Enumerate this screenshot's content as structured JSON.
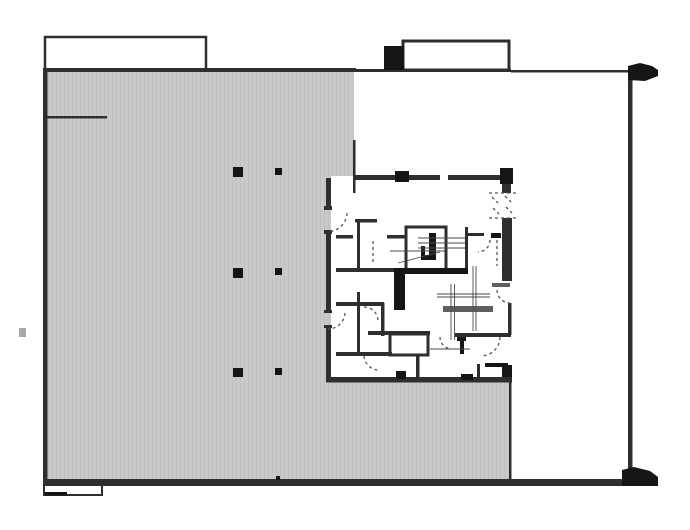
{
  "plan": {
    "viewbox": "0 0 690 530",
    "canvas": {
      "w": 690,
      "h": 530
    },
    "colors": {
      "background": "#ffffff",
      "wall": "#2e2e2e",
      "dark": "#151515",
      "mid": "#5f5f5f",
      "thin": "#4a4a4a",
      "dash": "#555555",
      "faint": "#a8a8a8",
      "deck_fill": "#c9c9c9",
      "deck_stripe": "#c1c1c1"
    },
    "deck_polygon": "47,72 354,72 354,176 331,176 331,380 510,380 510,480 47,480",
    "walls": [
      {
        "x": 43,
        "y": 68,
        "w": 313,
        "h": 4,
        "c": "wall",
        "name": "outer-top-wall-left"
      },
      {
        "x": 356,
        "y": 69,
        "w": 155,
        "h": 3,
        "c": "wall",
        "name": "outer-top-wall-mid"
      },
      {
        "x": 511,
        "y": 70,
        "w": 119,
        "h": 2.5,
        "c": "wall",
        "name": "outer-top-wall-right"
      },
      {
        "x": 43,
        "y": 70,
        "w": 4.5,
        "h": 413,
        "c": "wall",
        "name": "outer-left-wall"
      },
      {
        "x": 628,
        "y": 72,
        "w": 4.5,
        "h": 400,
        "c": "wall",
        "name": "outer-right-wall"
      },
      {
        "x": 43,
        "y": 479,
        "w": 593,
        "h": 7,
        "c": "wall",
        "name": "outer-bottom-wall"
      },
      {
        "x": 45,
        "y": 116,
        "w": 62,
        "h": 2.5,
        "c": "wall",
        "name": "interior-partition-topleft"
      },
      {
        "x": 353,
        "y": 140,
        "w": 2.5,
        "h": 53,
        "c": "wall",
        "name": "deck-edge-wall-north"
      },
      {
        "x": 509,
        "y": 380,
        "w": 2.5,
        "h": 100,
        "c": "wall",
        "name": "deck-edge-wall-south"
      },
      {
        "x": 45,
        "y": 492,
        "w": 22,
        "h": 3.5,
        "c": "dark",
        "name": "bottom-stoop-thick-edge"
      },
      {
        "x": 276,
        "y": 476,
        "w": 4,
        "h": 4,
        "c": "dark",
        "name": "bottom-wall-column-tick"
      },
      {
        "x": 384,
        "y": 46,
        "w": 20,
        "h": 24,
        "c": "dark",
        "name": "top-parapet-block"
      },
      {
        "x": 19,
        "y": 328,
        "w": 7,
        "h": 9,
        "c": "faint",
        "name": "left-margin-mark"
      },
      {
        "x": 355,
        "y": 175,
        "w": 85,
        "h": 5,
        "c": "wall",
        "name": "core-north-wall-west"
      },
      {
        "x": 448,
        "y": 175,
        "w": 54,
        "h": 5,
        "c": "wall",
        "name": "core-north-wall-east"
      },
      {
        "x": 395,
        "y": 171,
        "w": 14,
        "h": 11,
        "c": "dark",
        "name": "core-north-column"
      },
      {
        "x": 500,
        "y": 168,
        "w": 13,
        "h": 16,
        "c": "dark",
        "name": "core-northeast-column"
      },
      {
        "x": 502,
        "y": 184,
        "w": 9,
        "h": 9,
        "c": "wall",
        "name": "core-east-wall-upper"
      },
      {
        "x": 502,
        "y": 218,
        "w": 10,
        "h": 63,
        "c": "wall",
        "name": "core-east-wall-mid"
      },
      {
        "x": 492,
        "y": 283,
        "w": 18,
        "h": 4,
        "c": "mid",
        "name": "core-east-threshold"
      },
      {
        "x": 508,
        "y": 303,
        "w": 3.5,
        "h": 32,
        "c": "wall",
        "name": "core-east-wall-lower"
      },
      {
        "x": 502,
        "y": 365,
        "w": 10,
        "h": 16,
        "c": "dark",
        "name": "core-southeast-corner-block"
      },
      {
        "x": 326,
        "y": 178,
        "w": 5,
        "h": 32,
        "c": "wall",
        "name": "core-west-wall-a"
      },
      {
        "x": 326,
        "y": 233,
        "w": 5,
        "h": 79,
        "c": "wall",
        "name": "core-west-wall-b"
      },
      {
        "x": 326,
        "y": 327,
        "w": 5,
        "h": 51,
        "c": "wall",
        "name": "core-west-wall-c"
      },
      {
        "x": 324,
        "y": 206,
        "w": 8,
        "h": 4,
        "c": "wall",
        "name": "door-jamb-tick"
      },
      {
        "x": 324,
        "y": 230,
        "w": 8,
        "h": 4,
        "c": "wall",
        "name": "door-jamb-tick"
      },
      {
        "x": 324,
        "y": 310,
        "w": 8,
        "h": 3,
        "c": "wall",
        "name": "door-jamb-tick"
      },
      {
        "x": 324,
        "y": 325,
        "w": 8,
        "h": 3,
        "c": "wall",
        "name": "door-jamb-tick"
      },
      {
        "x": 326,
        "y": 377,
        "w": 186,
        "h": 5.5,
        "c": "wall",
        "name": "core-south-wall"
      },
      {
        "x": 396,
        "y": 371,
        "w": 10,
        "h": 8,
        "c": "dark",
        "name": "core-south-column"
      },
      {
        "x": 461,
        "y": 374,
        "w": 12,
        "h": 6,
        "c": "dark",
        "name": "core-south-stub"
      },
      {
        "x": 355,
        "y": 219,
        "w": 22,
        "h": 3.5,
        "c": "wall",
        "name": "corridor-north-wall"
      },
      {
        "x": 357,
        "y": 221,
        "w": 3,
        "h": 49,
        "c": "wall",
        "name": "room-wall-vertical-a"
      },
      {
        "x": 357,
        "y": 292,
        "w": 3,
        "h": 63,
        "c": "wall",
        "name": "room-wall-vertical-b"
      },
      {
        "x": 336,
        "y": 235,
        "w": 17,
        "h": 3.5,
        "c": "wall",
        "name": "door-stub-a"
      },
      {
        "x": 387,
        "y": 235,
        "w": 18,
        "h": 3.5,
        "c": "wall",
        "name": "door-stub-b"
      },
      {
        "x": 336,
        "y": 268,
        "w": 70,
        "h": 4,
        "c": "wall",
        "name": "room-south-wall-upper"
      },
      {
        "x": 465,
        "y": 227,
        "w": 3,
        "h": 44,
        "c": "wall",
        "name": "stair-landing-east-wall"
      },
      {
        "x": 467,
        "y": 233,
        "w": 17,
        "h": 3,
        "c": "wall",
        "name": "ne-room-partition"
      },
      {
        "x": 491,
        "y": 233,
        "w": 10,
        "h": 5,
        "c": "dark",
        "name": "ne-room-stub"
      },
      {
        "x": 440,
        "y": 268,
        "w": 28,
        "h": 4,
        "c": "wall",
        "name": "stair-landing-south-wall"
      },
      {
        "x": 394,
        "y": 268,
        "w": 11,
        "h": 42,
        "c": "dark",
        "name": "shaft-wall-block-west"
      },
      {
        "x": 405,
        "y": 268,
        "w": 63,
        "h": 6,
        "c": "dark",
        "name": "shaft-wall-block-south"
      },
      {
        "x": 429,
        "y": 233,
        "w": 7,
        "h": 27,
        "c": "dark",
        "name": "stair-newel-bar"
      },
      {
        "x": 421,
        "y": 255,
        "w": 15,
        "h": 5,
        "c": "dark",
        "name": "stair-newel-foot"
      },
      {
        "x": 421,
        "y": 246,
        "w": 4,
        "h": 14,
        "c": "dark",
        "name": "stair-newel-return"
      },
      {
        "x": 443,
        "y": 306,
        "w": 50,
        "h": 6,
        "c": "mid",
        "name": "washroom-counter"
      },
      {
        "x": 368,
        "y": 331,
        "w": 62,
        "h": 4,
        "c": "wall",
        "name": "washroom-south-wall-west"
      },
      {
        "x": 455,
        "y": 333,
        "w": 56,
        "h": 4,
        "c": "wall",
        "name": "washroom-south-wall-east"
      },
      {
        "x": 416,
        "y": 355,
        "w": 3.5,
        "h": 24,
        "c": "wall",
        "name": "lobby-wall-vertical"
      },
      {
        "x": 457,
        "y": 337,
        "w": 9,
        "h": 4,
        "c": "dark",
        "name": "fixture-tee-cap"
      },
      {
        "x": 460,
        "y": 341,
        "w": 4,
        "h": 13,
        "c": "dark",
        "name": "fixture-tee-stem"
      },
      {
        "x": 485,
        "y": 363,
        "w": 23,
        "h": 4,
        "c": "dark",
        "name": "south-room-stub"
      },
      {
        "x": 477,
        "y": 364,
        "w": 3,
        "h": 16,
        "c": "wall",
        "name": "south-room-wall"
      },
      {
        "x": 336,
        "y": 302,
        "w": 48,
        "h": 4,
        "c": "wall",
        "name": "west-room-divider-upper"
      },
      {
        "x": 381,
        "y": 303,
        "w": 3.5,
        "h": 33,
        "c": "wall",
        "name": "west-room-wall-vertical"
      },
      {
        "x": 336,
        "y": 352,
        "w": 56,
        "h": 4,
        "c": "wall",
        "name": "west-room-divider-lower"
      }
    ],
    "outlines": [
      {
        "x": 45,
        "y": 37,
        "w": 161,
        "h": 33,
        "sw": 2.5,
        "name": "roof-canopy-outline-left"
      },
      {
        "x": 403,
        "y": 41,
        "w": 106,
        "h": 29,
        "sw": 3,
        "name": "roof-canopy-outline-right"
      },
      {
        "x": 44,
        "y": 483,
        "w": 58,
        "h": 12,
        "sw": 2,
        "name": "entry-stoop-outline"
      },
      {
        "x": 406,
        "y": 227,
        "w": 40,
        "h": 44,
        "sw": 3,
        "name": "stair-shaft-outline"
      },
      {
        "x": 390,
        "y": 334,
        "w": 38,
        "h": 21,
        "sw": 3,
        "name": "elevator-lobby-outline"
      }
    ],
    "blobs": [
      {
        "d": "M628,80 L628,66 L640,63 L652,66 L658,70 L658,76 L645,81 Z",
        "name": "corner-cap-top-right"
      },
      {
        "d": "M622,486 L622,470 L634,467 L650,471 L658,477 L658,486 Z",
        "name": "corner-cap-bottom-right"
      }
    ],
    "columns": [
      {
        "x": 233,
        "y": 167,
        "w": 10,
        "h": 10
      },
      {
        "x": 275,
        "y": 168,
        "w": 7,
        "h": 7
      },
      {
        "x": 233,
        "y": 268,
        "w": 10,
        "h": 10
      },
      {
        "x": 275,
        "y": 268,
        "w": 7,
        "h": 7
      },
      {
        "x": 233,
        "y": 368,
        "w": 10,
        "h": 9
      },
      {
        "x": 275,
        "y": 368,
        "w": 7,
        "h": 7
      }
    ],
    "thin_lines": [
      {
        "x1": 418,
        "y1": 238,
        "x2": 465,
        "y2": 238
      },
      {
        "x1": 418,
        "y1": 243,
        "x2": 465,
        "y2": 243
      },
      {
        "x1": 418,
        "y1": 248,
        "x2": 465,
        "y2": 248
      },
      {
        "x1": 390,
        "y1": 251,
        "x2": 445,
        "y2": 251
      },
      {
        "x1": 398,
        "y1": 263,
        "x2": 440,
        "y2": 252
      },
      {
        "x1": 451,
        "y1": 284,
        "x2": 451,
        "y2": 340
      },
      {
        "x1": 454.5,
        "y1": 284,
        "x2": 454.5,
        "y2": 340
      },
      {
        "x1": 473,
        "y1": 266,
        "x2": 473,
        "y2": 331
      },
      {
        "x1": 476,
        "y1": 266,
        "x2": 476,
        "y2": 331
      },
      {
        "x1": 437,
        "y1": 294,
        "x2": 490,
        "y2": 294
      },
      {
        "x1": 437,
        "y1": 297,
        "x2": 490,
        "y2": 297
      },
      {
        "x1": 430,
        "y1": 349,
        "x2": 470,
        "y2": 349
      }
    ],
    "dashed_paths": [
      {
        "d": "M 347 213 A 20 20 0 0 1 328 232",
        "name": "door-swing"
      },
      {
        "d": "M 345 313 A 17 17 0 0 1 328 329",
        "name": "door-swing"
      },
      {
        "d": "M 364 307 A 14 14 0 0 1 378 320",
        "name": "door-swing"
      },
      {
        "d": "M 364 356 A 15 15 0 0 0 379 370",
        "name": "door-swing"
      },
      {
        "d": "M 500 337 A 19 19 0 0 1 481 356",
        "name": "door-swing"
      },
      {
        "d": "M 497 290 A 13 13 0 0 0 510 303",
        "name": "door-swing"
      },
      {
        "d": "M 490 240 A 12 12 0 0 1 478 252",
        "name": "door-swing"
      },
      {
        "d": "M 440 337 A 12 12 0 0 0 452 349",
        "name": "door-swing"
      },
      {
        "d": "M 373 241 L 373 264",
        "name": "door-leader"
      },
      {
        "d": "M 497 240 L 497 266",
        "name": "door-leader"
      },
      {
        "d": "M 492 197 L 498 203",
        "name": "shaft-hatch"
      },
      {
        "d": "M 505 196 L 511 202",
        "name": "shaft-hatch"
      },
      {
        "d": "M 493 208 L 499 214",
        "name": "shaft-hatch"
      },
      {
        "d": "M 506 207 L 512 213",
        "name": "shaft-hatch"
      },
      {
        "d": "M 489 218 L 517 218",
        "name": "shaft-edge"
      },
      {
        "d": "M 489 193 L 517 193",
        "name": "shaft-edge"
      }
    ]
  }
}
